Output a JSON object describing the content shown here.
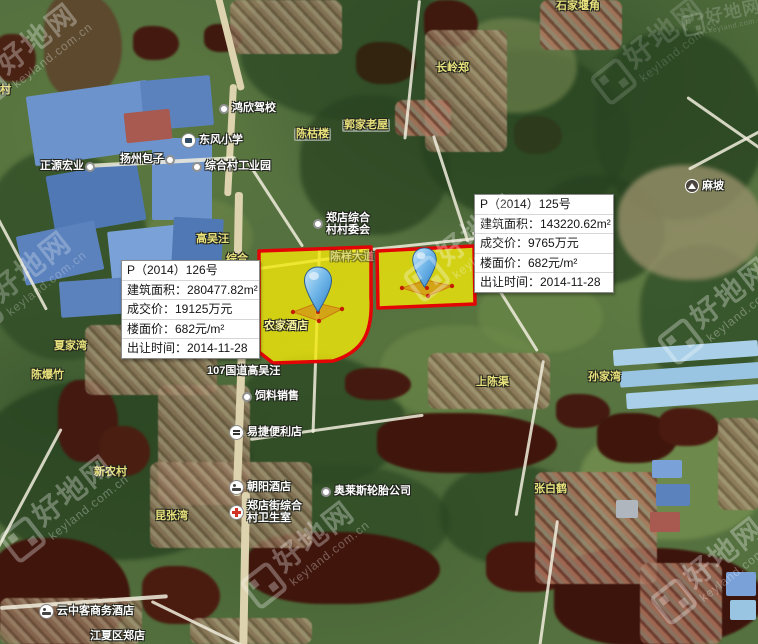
{
  "watermark": {
    "brand": "好地网",
    "domain": "keyland.com.cn"
  },
  "colors": {
    "parcel_fill": "#f2e90a",
    "parcel_border": "#e30505",
    "pin_blue": "#6fb5e8",
    "water": "#40160c",
    "label_yellow": "#e9e27c",
    "label_white": "#ffffff"
  },
  "parcels": [
    {
      "id": "126",
      "title": "P（2014）126号",
      "rows": [
        "建筑面积：280477.82m²",
        "成交价：19125万元",
        "楼面价：682元/m²",
        "出让时间：2014-11-28"
      ]
    },
    {
      "id": "125",
      "title": "P（2014）125号",
      "rows": [
        "建筑面积：143220.62m²",
        "成交价：9765万元",
        "楼面价：682元/m²",
        "出让时间：2014-11-28"
      ]
    }
  ],
  "map": {
    "labels": [
      {
        "text": "石家堰角",
        "x": 556,
        "y": 0,
        "color": "yellow"
      },
      {
        "text": "长岭郑",
        "x": 436,
        "y": 62,
        "color": "yellow"
      },
      {
        "text": "鸿欣驾校",
        "x": 218,
        "y": 102,
        "color": "white",
        "icon": "dot"
      },
      {
        "text": "东风小学",
        "x": 180,
        "y": 133,
        "color": "white",
        "icon": "school"
      },
      {
        "text": "扬州包子",
        "x": 120,
        "y": 153,
        "color": "white",
        "icon": "dot",
        "icon_side": "right"
      },
      {
        "text": "正源宏业",
        "x": 40,
        "y": 160,
        "color": "white",
        "icon": "dot",
        "icon_side": "right"
      },
      {
        "text": "综合村工业园",
        "x": 191,
        "y": 160,
        "color": "white",
        "icon": "dot"
      },
      {
        "text": "陈枯楼",
        "x": 294,
        "y": 128,
        "color": "plate"
      },
      {
        "text": "郭家老屋",
        "x": 342,
        "y": 119,
        "color": "plate"
      },
      {
        "text": "郑店综合村村委会",
        "x": 312,
        "y": 212,
        "color": "white",
        "icon": "dot",
        "lines": [
          "郑店综合",
          "村村委会"
        ]
      },
      {
        "text": "高吴汪",
        "x": 196,
        "y": 233,
        "color": "yellow"
      },
      {
        "text": "综合",
        "x": 226,
        "y": 253,
        "color": "yellow",
        "under": true
      },
      {
        "text": "陈样大道",
        "x": 330,
        "y": 251,
        "color": "dim"
      },
      {
        "text": "麻坡",
        "x": 684,
        "y": 179,
        "color": "white",
        "icon": "mountain"
      },
      {
        "text": "农家酒店",
        "x": 264,
        "y": 320,
        "color": "parcel"
      },
      {
        "text": "107国道高吴汪",
        "x": 207,
        "y": 365,
        "color": "white"
      },
      {
        "text": "饲料销售",
        "x": 241,
        "y": 390,
        "color": "white",
        "icon": "dot"
      },
      {
        "text": "易捷便利店",
        "x": 228,
        "y": 425,
        "color": "white",
        "icon": "shop"
      },
      {
        "text": "新农村",
        "x": 94,
        "y": 466,
        "color": "yellow"
      },
      {
        "text": "朝阳酒店",
        "x": 228,
        "y": 480,
        "color": "white",
        "icon": "bed"
      },
      {
        "text": "奥莱斯轮胎公司",
        "x": 320,
        "y": 485,
        "color": "white",
        "icon": "dot"
      },
      {
        "text": "郑店街综合村卫生室",
        "x": 228,
        "y": 500,
        "color": "white",
        "icon": "hospital",
        "lines": [
          "郑店街综合",
          "村卫生室"
        ]
      },
      {
        "text": "昆张湾",
        "x": 155,
        "y": 510,
        "color": "yellow"
      },
      {
        "text": "夏家湾",
        "x": 54,
        "y": 340,
        "color": "yellow"
      },
      {
        "text": "陈爆竹",
        "x": 31,
        "y": 369,
        "color": "yellow"
      },
      {
        "text": "上陈渠",
        "x": 476,
        "y": 376,
        "color": "yellow"
      },
      {
        "text": "孙家湾",
        "x": 588,
        "y": 371,
        "color": "yellow"
      },
      {
        "text": "张白鹤",
        "x": 534,
        "y": 483,
        "color": "yellow"
      },
      {
        "text": "云中客商务酒店",
        "x": 38,
        "y": 604,
        "color": "white",
        "icon": "bed"
      },
      {
        "text": "江夏区郑店",
        "x": 90,
        "y": 630,
        "color": "white"
      },
      {
        "text": "村",
        "x": 0,
        "y": 84,
        "color": "yellow"
      }
    ]
  }
}
